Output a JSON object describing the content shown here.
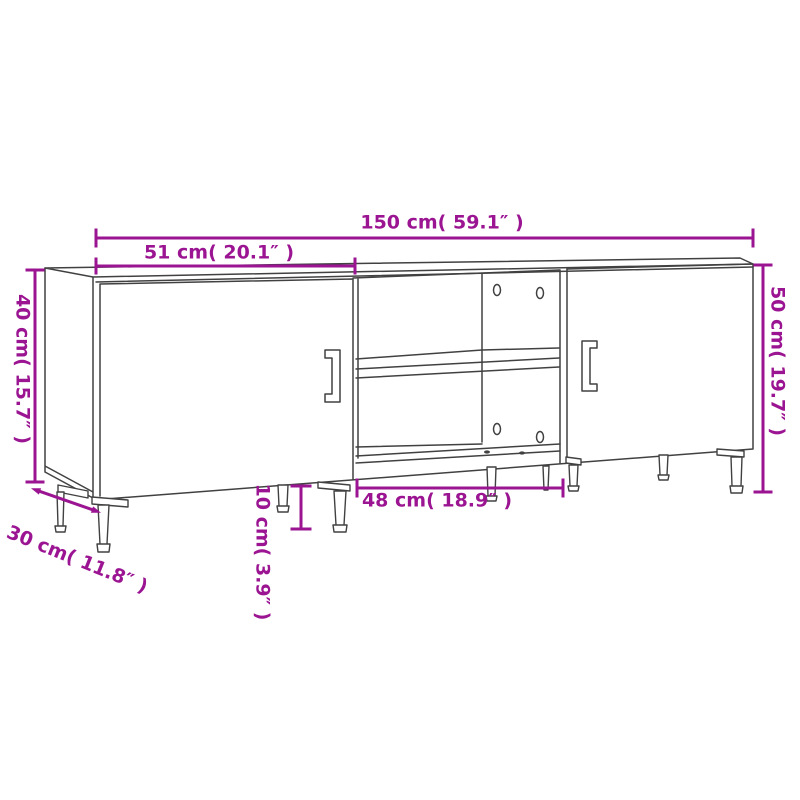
{
  "dimensions": {
    "total_width": {
      "label": "150 cm( 59.1″ )",
      "value_cm": 150,
      "value_in": 59.1
    },
    "left_width": {
      "label": "51 cm( 20.1″ )",
      "value_cm": 51,
      "value_in": 20.1
    },
    "left_height": {
      "label": "40 cm( 15.7″ )",
      "value_cm": 40,
      "value_in": 15.7
    },
    "right_height": {
      "label": "50 cm( 19.7″ )",
      "value_cm": 50,
      "value_in": 19.7
    },
    "depth": {
      "label": "30 cm( 11.8″ )",
      "value_cm": 30,
      "value_in": 11.8
    },
    "leg_height": {
      "label": "10 cm( 3.9″ )",
      "value_cm": 10,
      "value_in": 3.9
    },
    "opening_width": {
      "label": "48 cm( 18.9″ )",
      "value_cm": 48,
      "value_in": 18.9
    }
  },
  "colors": {
    "dimension": "#9b1492",
    "line": "#414141",
    "background": "#ffffff"
  }
}
